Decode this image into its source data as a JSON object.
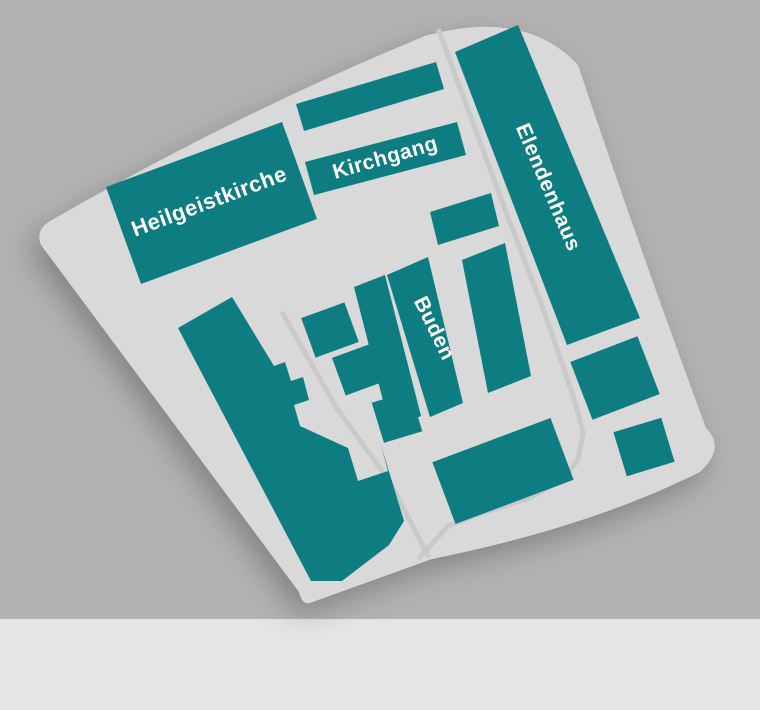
{
  "canvas": {
    "width": 760,
    "height": 710
  },
  "colors": {
    "background": "#b2b2b2",
    "parcel": "#d9d9d9",
    "building": "#0e7d82",
    "street": "#c9c9c9",
    "label": "#ffffff",
    "divider": "#d9d9d9",
    "footer": "#e5e5e5"
  },
  "map": {
    "parcel_path": "M 50 221 Q 240 112 425 36 Q 525 8 578 65 Q 640 250 706 428 Q 726 448 700 472 Q 590 527 432 559 L 310 603 Q 302 605 299 592 L 41 245 Q 35 230 50 221 Z",
    "footer": {
      "y": 619,
      "height": 91
    },
    "streets": [
      {
        "name": "lane-west",
        "width": 5,
        "points": [
          [
            283,
            314
          ],
          [
            336,
            407
          ],
          [
            390,
            482
          ],
          [
            428,
            556
          ]
        ]
      },
      {
        "name": "lane-east-loop",
        "width": 5,
        "points": [
          [
            439,
            31
          ],
          [
            470,
            115
          ],
          [
            509,
            220
          ],
          [
            541,
            303
          ],
          [
            562,
            363
          ],
          [
            576,
            405
          ],
          [
            583,
            433
          ],
          [
            578,
            460
          ],
          [
            561,
            481
          ],
          [
            527,
            499
          ],
          [
            482,
            513
          ],
          [
            448,
            526
          ],
          [
            420,
            557
          ]
        ]
      }
    ],
    "divider": {
      "name": "church-divider-line",
      "x1": 283,
      "y1": 121,
      "x2": 318,
      "y2": 218,
      "width": 1.5
    },
    "buildings": [
      {
        "name": "heilgeistkirche",
        "poly": [
          [
            106,
            187
          ],
          [
            282,
            122
          ],
          [
            317,
            219
          ],
          [
            141,
            284
          ]
        ]
      },
      {
        "name": "north-wing",
        "poly": [
          [
            296,
            104
          ],
          [
            436,
            62
          ],
          [
            444,
            89
          ],
          [
            304,
            131
          ]
        ]
      },
      {
        "name": "kirchgang-wing",
        "poly": [
          [
            305,
            162
          ],
          [
            457,
            122
          ],
          [
            466,
            155
          ],
          [
            314,
            195
          ]
        ]
      },
      {
        "name": "elendenhaus",
        "poly": [
          [
            455,
            52
          ],
          [
            518,
            25
          ],
          [
            640,
            318
          ],
          [
            567,
            345
          ]
        ]
      },
      {
        "name": "main-hall",
        "poly": [
          [
            178,
            328
          ],
          [
            232,
            297
          ],
          [
            274,
            366
          ],
          [
            285,
            362
          ],
          [
            291,
            381
          ],
          [
            303,
            377
          ],
          [
            309,
            400
          ],
          [
            294,
            405
          ],
          [
            300,
            426
          ],
          [
            348,
            448
          ],
          [
            358,
            481
          ],
          [
            388,
            471
          ],
          [
            381,
            445
          ],
          [
            404,
            521
          ],
          [
            389,
            545
          ],
          [
            342,
            581
          ],
          [
            311,
            581
          ]
        ]
      },
      {
        "name": "buden-row",
        "poly": [
          [
            387,
            275
          ],
          [
            428,
            257
          ],
          [
            463,
            403
          ],
          [
            430,
            417
          ]
        ]
      },
      {
        "name": "buden-row-west",
        "poly": [
          [
            354,
            287
          ],
          [
            385,
            275
          ],
          [
            421,
            416
          ],
          [
            390,
            428
          ]
        ]
      },
      {
        "name": "mid-house-north",
        "poly": [
          [
            430,
            212
          ],
          [
            491,
            193
          ],
          [
            499,
            226
          ],
          [
            438,
            245
          ]
        ]
      },
      {
        "name": "mid-house-tall",
        "poly": [
          [
            462,
            260
          ],
          [
            505,
            243
          ],
          [
            531,
            376
          ],
          [
            488,
            393
          ]
        ]
      },
      {
        "name": "bude-1",
        "rect": {
          "cx": 330,
          "cy": 330,
          "w": 46,
          "h": 42,
          "angle": -20
        }
      },
      {
        "name": "bude-2",
        "rect": {
          "cx": 360,
          "cy": 369,
          "w": 45,
          "h": 40,
          "angle": -20
        }
      },
      {
        "name": "bude-3",
        "rect": {
          "cx": 397,
          "cy": 417,
          "w": 40,
          "h": 42,
          "angle": -17
        }
      },
      {
        "name": "south-house",
        "rect": {
          "cx": 503,
          "cy": 471,
          "w": 126,
          "h": 66,
          "angle": -20.5
        }
      },
      {
        "name": "east-house-1",
        "rect": {
          "cx": 615,
          "cy": 378,
          "w": 72,
          "h": 62,
          "angle": -21
        }
      },
      {
        "name": "east-house-2",
        "rect": {
          "cx": 644,
          "cy": 447,
          "w": 50,
          "h": 46,
          "angle": -17
        }
      }
    ],
    "labels": [
      {
        "name": "heilgeistkirche",
        "text": "Heilgeistkirche",
        "x": 209,
        "y": 201,
        "rotate": -20.5,
        "size": 22
      },
      {
        "name": "kirchgang",
        "text": "Kirchgang",
        "x": 385,
        "y": 157,
        "rotate": -16,
        "size": 21
      },
      {
        "name": "elendenhaus",
        "text": "Elendenhaus",
        "x": 549,
        "y": 187,
        "rotate": 67,
        "size": 21
      },
      {
        "name": "buden",
        "text": "Buden",
        "x": 435,
        "y": 328,
        "rotate": 64,
        "size": 21
      }
    ]
  }
}
